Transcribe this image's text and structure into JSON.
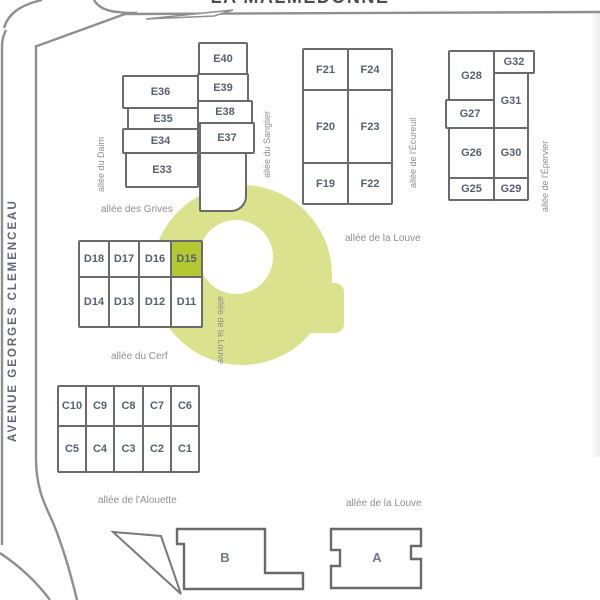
{
  "title": "LA MALMEDONNE",
  "streets": {
    "avenue": "AVENUE GEORGES CLEMENCEAU",
    "daim": "allée du Daim",
    "grives": "allée des Grives",
    "sanglier": "allée du Sanglier",
    "ecureuil": "allée de l'Écureuil",
    "epervier": "allée de l'Épervier",
    "louve_f": "allée de la Louve",
    "louve_d": "allée de la Louve",
    "cerf": "allée du Cerf",
    "alouette": "allée de l'Alouette",
    "louve_bottom": "allée de la Louve"
  },
  "blocks": {
    "e_left": [
      "E36",
      "E35",
      "E34",
      "E33"
    ],
    "e_right": [
      "E40",
      "E39",
      "E38",
      "E37"
    ],
    "f": [
      "F21",
      "F24",
      "F20",
      "F23",
      "F19",
      "F22"
    ],
    "g_left": [
      "G28",
      "G27",
      "G26",
      "G25"
    ],
    "g_right": [
      "G32",
      "G31",
      "G30",
      "G29"
    ],
    "d_top": [
      "D18",
      "D17",
      "D16",
      "D15"
    ],
    "d_bottom": [
      "D14",
      "D13",
      "D12",
      "D11"
    ],
    "c_top": [
      "C10",
      "C9",
      "C8",
      "C7",
      "C6"
    ],
    "c_bottom": [
      "C5",
      "C4",
      "C3",
      "C2",
      "C1"
    ],
    "a": "A",
    "b": "B"
  },
  "highlight": {
    "highlighted_unit": "D15",
    "ring_color": "#dbe28e",
    "selected_color": "#b3c832"
  },
  "colors": {
    "building_outline": "#6a6a6a",
    "road": "#8f8f8f",
    "unit_label": "#55616e",
    "street_label": "#8f8f8f"
  }
}
